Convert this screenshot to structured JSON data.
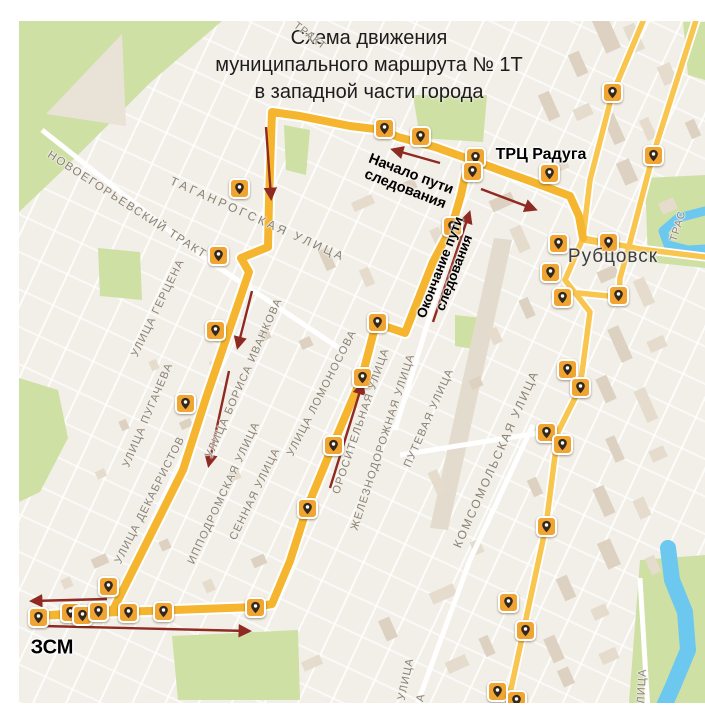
{
  "title": {
    "line1": "Схема движения",
    "line2": "муниципального маршрута № 1Т",
    "line3": "в западной части города"
  },
  "colors": {
    "map_background": "#f2efe8",
    "route_yellow": "#f5b52e",
    "minor_road_yellow": "#f8c54e",
    "road_casing": "#ffffff",
    "pin_badge": "#f0a432",
    "pin_glyph": "#33281c",
    "arrow_red": "#8e2a22",
    "green_area": "#cfe0a5",
    "river_blue": "#6cc8ef",
    "street_label_gray": "#8a8176",
    "building_beige": "#e5dccd",
    "building_beige_dark": "#ddd2c2"
  },
  "map": {
    "city_label": {
      "text": "Рубцовск",
      "x": 613,
      "y": 257,
      "size": 19
    },
    "landmarks": [
      {
        "text": "ТРЦ Радуга",
        "x": 541,
        "y": 155,
        "size": 16
      },
      {
        "text": "ЗСМ",
        "x": 52,
        "y": 648,
        "size": 20
      }
    ],
    "annotations": [
      {
        "lines": "Начало пути\nследования",
        "x": 408,
        "y": 182,
        "rot": 21,
        "size": 14.5
      },
      {
        "lines": "Окончание пути\nследования",
        "x": 447,
        "y": 270,
        "rot": -69,
        "size": 13.5
      }
    ],
    "street_labels": [
      {
        "text": "НОВОЕГОРЬЕВСКИЙ ТРАКТ",
        "x": 127,
        "y": 205,
        "rot": 33,
        "size": 11.5,
        "ls": 1.5
      },
      {
        "text": "ТАГАНРОГСКАЯ УЛИЦА",
        "x": 258,
        "y": 219,
        "rot": 24,
        "size": 12,
        "ls": 3
      },
      {
        "text": "УЛИЦА ГЕРЦЕНА",
        "x": 158,
        "y": 308,
        "rot": -64
      },
      {
        "text": "УЛИЦА ПУГАЧЕВА",
        "x": 148,
        "y": 415,
        "rot": -67
      },
      {
        "text": "УЛИЦА ДЕКАБРИСТОВ",
        "x": 150,
        "y": 500,
        "rot": -63
      },
      {
        "text": "УЛИЦА БОРИСА ИВАНКОВА",
        "x": 244,
        "y": 378,
        "rot": -66
      },
      {
        "text": "ИППОДРОМСКАЯ УЛИЦА",
        "x": 224,
        "y": 493,
        "rot": -65
      },
      {
        "text": "СЕННАЯ УЛИЦА",
        "x": 255,
        "y": 494,
        "rot": -64
      },
      {
        "text": "УЛИЦА ЛОМОНОСОВА",
        "x": 322,
        "y": 393,
        "rot": -63
      },
      {
        "text": "ОРОСИТЕЛЬНАЯ УЛИЦА",
        "x": 361,
        "y": 421,
        "rot": -71
      },
      {
        "text": "ЖЕЛЕЗНОДОРОЖНАЯ УЛИЦА",
        "x": 383,
        "y": 442,
        "rot": -72
      },
      {
        "text": "ПУТЕВАЯ УЛИЦА",
        "x": 429,
        "y": 418,
        "rot": -66
      },
      {
        "text": "КОМСОМОЛЬСКАЯ УЛИЦА",
        "x": 496,
        "y": 459,
        "rot": -66,
        "size": 12,
        "ls": 2
      },
      {
        "text": "ТРАКТ",
        "x": 310,
        "y": 36,
        "rot": 38,
        "size": 10.5
      },
      {
        "text": "ТРАС",
        "x": 678,
        "y": 226,
        "rot": -73,
        "size": 10.5
      },
      {
        "text": "УЛИЦА",
        "x": 406,
        "y": 679,
        "rot": -78
      },
      {
        "text": "ЦА",
        "x": 420,
        "y": 702,
        "rot": -78
      },
      {
        "text": "ЛИЦА",
        "x": 642,
        "y": 686,
        "rot": -87
      }
    ],
    "route": {
      "width": 8,
      "casing": 12,
      "paths": [
        [
          [
            480,
            163
          ],
          [
            435,
            147
          ],
          [
            398,
            137
          ],
          [
            383,
            130
          ],
          [
            350,
            126
          ],
          [
            300,
            116
          ],
          [
            272,
            112
          ],
          [
            269,
            200
          ],
          [
            268,
            247
          ],
          [
            241,
            258
          ],
          [
            249,
            272
          ],
          [
            206,
            398
          ],
          [
            183,
            470
          ],
          [
            113,
            610
          ],
          [
            38,
            616
          ]
        ],
        [
          [
            38,
            616
          ],
          [
            120,
            612
          ],
          [
            255,
            607
          ],
          [
            272,
            604
          ],
          [
            290,
            561
          ],
          [
            307,
            508
          ],
          [
            333,
            445
          ],
          [
            362,
            377
          ],
          [
            374,
            331
          ],
          [
            384,
            326
          ],
          [
            405,
            333
          ],
          [
            433,
            262
          ],
          [
            452,
            226
          ],
          [
            461,
            195
          ],
          [
            466,
            172
          ],
          [
            474,
            164
          ],
          [
            480,
            163
          ]
        ],
        [
          [
            480,
            163
          ],
          [
            530,
            181
          ],
          [
            570,
            196
          ],
          [
            579,
            216
          ],
          [
            583,
            238
          ]
        ]
      ]
    },
    "roads": [
      [
        [
          652,
          0
        ],
        [
          612,
          95
        ],
        [
          590,
          180
        ],
        [
          583,
          238
        ]
      ],
      [
        [
          700,
          8
        ],
        [
          653,
          155
        ],
        [
          628,
          250
        ],
        [
          620,
          278
        ],
        [
          619,
          300
        ]
      ],
      [
        [
          619,
          297
        ],
        [
          578,
          293
        ]
      ],
      [
        [
          583,
          238
        ],
        [
          565,
          280
        ],
        [
          590,
          312
        ],
        [
          580,
          388
        ],
        [
          558,
          432
        ],
        [
          546,
          526
        ],
        [
          529,
          605
        ],
        [
          508,
          703
        ]
      ],
      [
        [
          583,
          240
        ],
        [
          614,
          245
        ]
      ],
      [
        [
          583,
          238
        ],
        [
          640,
          249
        ],
        [
          705,
          257
        ]
      ]
    ],
    "white_roads": [
      [
        [
          42,
          130
        ],
        [
          200,
          255
        ],
        [
          345,
          352
        ]
      ],
      [
        [
          533,
          425
        ],
        [
          470,
          560
        ],
        [
          415,
          710
        ]
      ],
      [
        [
          640,
          578
        ],
        [
          648,
          712
        ]
      ],
      [
        [
          400,
          455
        ],
        [
          545,
          432
        ]
      ],
      [
        [
          450,
          250
        ],
        [
          395,
          430
        ]
      ]
    ],
    "rivers": [
      {
        "w": 9,
        "pts": [
          [
            705,
            211
          ],
          [
            678,
            218
          ],
          [
            663,
            231
          ],
          [
            668,
            245
          ],
          [
            688,
            250
          ],
          [
            705,
            249
          ]
        ]
      },
      {
        "w": 16,
        "pts": [
          [
            668,
            548
          ],
          [
            672,
            580
          ],
          [
            685,
            612
          ],
          [
            688,
            650
          ],
          [
            673,
            686
          ],
          [
            660,
            715
          ]
        ]
      }
    ],
    "green_areas": [
      "19,21 222,21 150,83 60,173 19,212",
      "98,248 140,252 142,300 100,296",
      "284,125 310,130 306,175 286,170",
      "413,95 487,95 483,142 420,138",
      "455,315 482,318 478,350 455,346",
      "645,178 705,175 705,268 648,262",
      "683,22 705,22 705,80 688,75",
      "172,636 298,630 300,700 178,700",
      "640,560 705,555 705,715 628,715",
      "19,378 58,390 68,438 40,492 19,502"
    ],
    "railway_strip": "494,238 512,240 448,530 430,528",
    "stops": [
      [
        384,
        128
      ],
      [
        420,
        136
      ],
      [
        475,
        157
      ],
      [
        472,
        171
      ],
      [
        549,
        173
      ],
      [
        239,
        188
      ],
      [
        218,
        255
      ],
      [
        215,
        330
      ],
      [
        185,
        403
      ],
      [
        108,
        586
      ],
      [
        38,
        617
      ],
      [
        70,
        612
      ],
      [
        82,
        615
      ],
      [
        98,
        611
      ],
      [
        128,
        612
      ],
      [
        163,
        611
      ],
      [
        255,
        607
      ],
      [
        307,
        508
      ],
      [
        333,
        445
      ],
      [
        362,
        377
      ],
      [
        377,
        322
      ],
      [
        452,
        226
      ],
      [
        558,
        243
      ],
      [
        608,
        242
      ],
      [
        550,
        272
      ],
      [
        562,
        297
      ],
      [
        618,
        295
      ],
      [
        567,
        369
      ],
      [
        580,
        387
      ],
      [
        546,
        432
      ],
      [
        562,
        444
      ],
      [
        546,
        526
      ],
      [
        508,
        602
      ],
      [
        525,
        630
      ],
      [
        497,
        691
      ],
      [
        516,
        700
      ],
      [
        612,
        92
      ],
      [
        653,
        155
      ]
    ],
    "arrows": [
      [
        440,
        163,
        394,
        150
      ],
      [
        266,
        127,
        271,
        197
      ],
      [
        252,
        291,
        238,
        346
      ],
      [
        229,
        371,
        209,
        464
      ],
      [
        107,
        599,
        33,
        601
      ],
      [
        43,
        626,
        248,
        631
      ],
      [
        330,
        488,
        362,
        385
      ],
      [
        433,
        322,
        469,
        214
      ],
      [
        481,
        189,
        534,
        209
      ]
    ]
  }
}
